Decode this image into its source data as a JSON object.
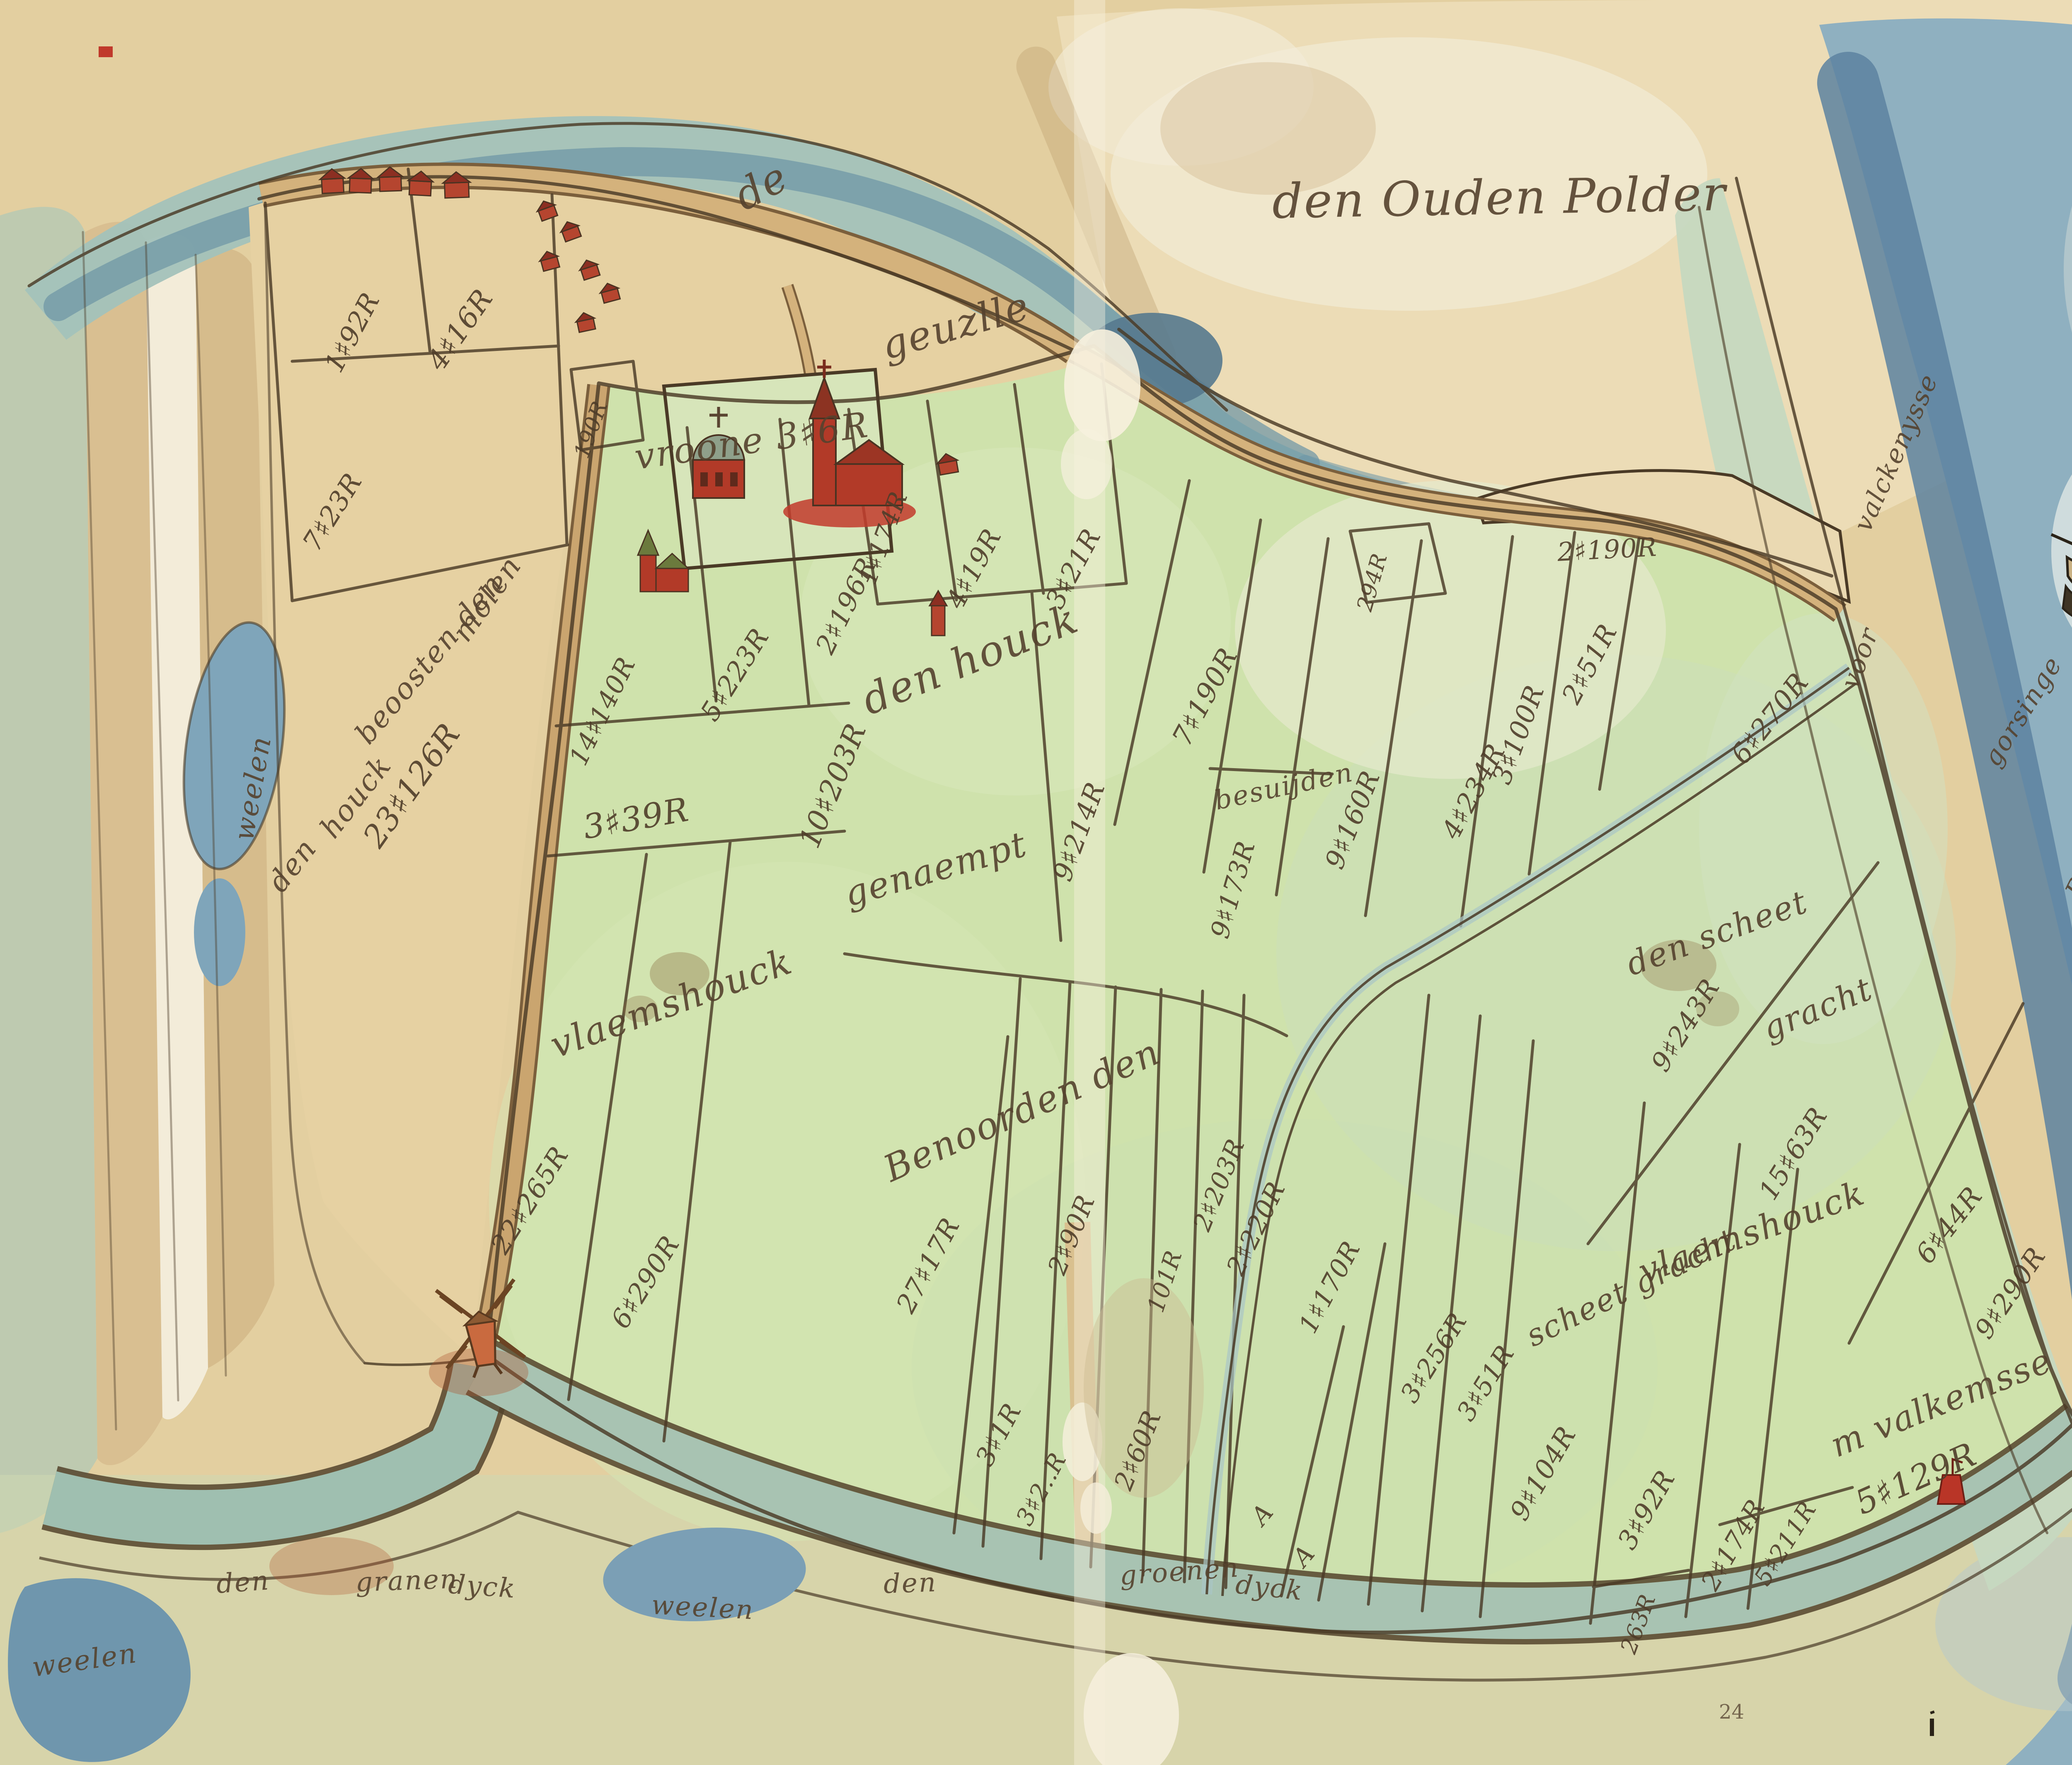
{
  "map": {
    "type": "hand-drawn watercolour polder map (17th-century manuscript)",
    "page_number": "24",
    "corner_mark": "fo",
    "palette": {
      "parchment": "#e6d2a4",
      "old_land": "#ecdcb6",
      "polder_green": "#cfe2ac",
      "water_deep": "#5d82a0",
      "water_light": "#9fc0b8",
      "marsh_green": "#c6d8c0",
      "dyke_tan": "#caa56f",
      "building_red": "#b5452f",
      "ink": "#4a3a26",
      "label_ink": "#5a4732"
    },
    "features": {
      "windmill": "red post mill at south-west dyke corner",
      "church": "red church with spire in enclosure",
      "chapel": "domed chapel beside church",
      "ship": "single-masted sailing ship on the Honte",
      "ship_flag_stripes": [
        "#c0392b",
        "#e9e4d2",
        "#7fae7a"
      ],
      "beacon": "small red beacon in water",
      "houses": "rows of red village houses along the dyke road",
      "ponds": "blue weelen (dike-breach pools)"
    },
    "labels": [
      {
        "name": "label-de",
        "text": "de"
      },
      {
        "name": "label-geule",
        "text": "geuzlle"
      },
      {
        "name": "label-den-ouden-polder",
        "text": "den Ouden Polder"
      },
      {
        "name": "label-weelen-west",
        "text": "weelen"
      },
      {
        "name": "label-molen",
        "text": "molen"
      },
      {
        "name": "label-beoosten-den",
        "text": "beoosten den"
      },
      {
        "name": "label-houck",
        "text": "houck"
      },
      {
        "name": "label-den",
        "text": "den"
      },
      {
        "name": "parcel-area-label",
        "text": "23♯126R"
      },
      {
        "name": "label-vroone",
        "text": "vroone 3♯6R"
      },
      {
        "name": "label-den-houck",
        "text": "den houck"
      },
      {
        "name": "parcel-area-label",
        "text": "10♯203R"
      },
      {
        "name": "label-genaempt",
        "text": "genaempt"
      },
      {
        "name": "label-vlaemshouck-west",
        "text": "vlaemshouck"
      },
      {
        "name": "label-benoorden-den",
        "text": "Benoorden den"
      },
      {
        "name": "label-besuijden",
        "text": "besuijden"
      },
      {
        "name": "label-den-scheet",
        "text": "den scheet"
      },
      {
        "name": "label-gracht",
        "text": "gracht"
      },
      {
        "name": "label-vlaemshouck-east",
        "text": "vlaemshouck"
      },
      {
        "name": "label-scheet-gracht",
        "text": "scheet gracht"
      },
      {
        "name": "label-valkenisse",
        "text": "m valkemsse"
      },
      {
        "name": "parcel-area-label",
        "text": "5♯129R"
      },
      {
        "name": "label-dyck-den",
        "text": "den"
      },
      {
        "name": "label-dyck-granen",
        "text": "granen"
      },
      {
        "name": "label-dyck-dyck",
        "text": "dyck"
      },
      {
        "name": "label-weelen-south",
        "text": "weelen"
      },
      {
        "name": "label-dyck-den2",
        "text": "den"
      },
      {
        "name": "label-dyck-groenen",
        "text": "groenen"
      },
      {
        "name": "label-dyck-dyck2",
        "text": "dyck"
      },
      {
        "name": "label-weelen-southwest",
        "text": "weelen"
      },
      {
        "name": "label-valckenysse",
        "text": "valckenysse"
      },
      {
        "name": "label-voor",
        "text": "voor"
      },
      {
        "name": "label-gorsinge",
        "text": "gorsinge"
      },
      {
        "name": "label-buyten",
        "text": "Buyten"
      },
      {
        "name": "label-flemmins",
        "text": "flemmins"
      },
      {
        "name": "label-honta",
        "text": "Honta"
      },
      {
        "name": "label-folio-mark",
        "text": "fo"
      },
      {
        "name": "parcel-area-label",
        "text": "1♯92R"
      },
      {
        "name": "parcel-area-label",
        "text": "4♯16R"
      },
      {
        "name": "parcel-area-label",
        "text": "190R"
      },
      {
        "name": "parcel-area-label",
        "text": "7♯23R"
      },
      {
        "name": "parcel-area-label",
        "text": "14♯140R"
      },
      {
        "name": "parcel-area-label",
        "text": "5♯223R"
      },
      {
        "name": "parcel-area-label",
        "text": "2♯196R"
      },
      {
        "name": "parcel-area-label",
        "text": "1♯174R"
      },
      {
        "name": "parcel-area-label",
        "text": "4♯19R"
      },
      {
        "name": "parcel-area-label",
        "text": "3♯21R"
      },
      {
        "name": "parcel-area-label",
        "text": "3♯39R"
      },
      {
        "name": "parcel-area-label",
        "text": "9♯214R"
      },
      {
        "name": "parcel-area-label",
        "text": "7♯190R"
      },
      {
        "name": "parcel-area-label",
        "text": "9♯173R"
      },
      {
        "name": "parcel-area-label",
        "text": "9♯160R"
      },
      {
        "name": "parcel-area-label",
        "text": "4♯234R"
      },
      {
        "name": "parcel-area-label",
        "text": "3♯100R"
      },
      {
        "name": "parcel-area-label",
        "text": "2♯51R"
      },
      {
        "name": "parcel-area-label",
        "text": "6♯270R"
      },
      {
        "name": "parcel-area-label",
        "text": "294R"
      },
      {
        "name": "parcel-area-label",
        "text": "2♯190R"
      },
      {
        "name": "parcel-area-label",
        "text": "9♯243R"
      },
      {
        "name": "parcel-area-label",
        "text": "15♯63R"
      },
      {
        "name": "parcel-area-label",
        "text": "6♯44R"
      },
      {
        "name": "parcel-area-label",
        "text": "9♯290R"
      },
      {
        "name": "parcel-area-label",
        "text": "22♯265R"
      },
      {
        "name": "parcel-area-label",
        "text": "6♯290R"
      },
      {
        "name": "parcel-area-label",
        "text": "27♯17R"
      },
      {
        "name": "parcel-area-label",
        "text": "2♯90R"
      },
      {
        "name": "parcel-area-label",
        "text": "101R"
      },
      {
        "name": "parcel-area-label",
        "text": "2♯203R"
      },
      {
        "name": "parcel-area-label",
        "text": "2♯220R"
      },
      {
        "name": "parcel-area-label",
        "text": "1♯170R"
      },
      {
        "name": "parcel-area-label",
        "text": "3♯256R"
      },
      {
        "name": "parcel-area-label",
        "text": "3♯51R"
      },
      {
        "name": "parcel-area-label",
        "text": "9♯104R"
      },
      {
        "name": "parcel-area-label",
        "text": "3♯92R"
      },
      {
        "name": "parcel-area-label",
        "text": "2♯174R"
      },
      {
        "name": "parcel-area-label",
        "text": "3♯1R"
      },
      {
        "name": "parcel-area-label",
        "text": "3♯2..R"
      },
      {
        "name": "parcel-area-label",
        "text": "2♯60R"
      },
      {
        "name": "parcel-letter",
        "text": "A"
      },
      {
        "name": "parcel-letter",
        "text": "A"
      },
      {
        "name": "parcel-area-label",
        "text": "5♯211R"
      },
      {
        "name": "parcel-area-label",
        "text": "263R"
      },
      {
        "name": "page-number",
        "text": "24"
      }
    ]
  }
}
